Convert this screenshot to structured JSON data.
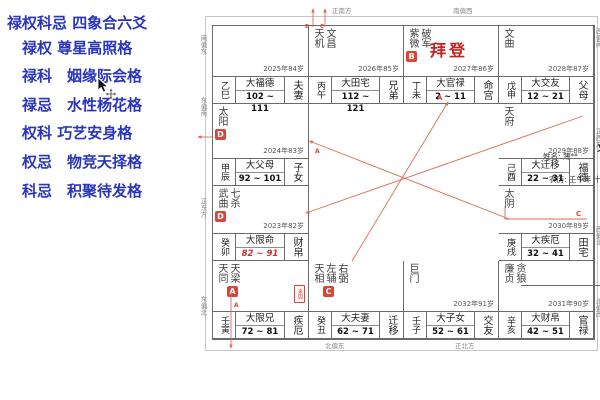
{
  "sidebar": {
    "color": "#2936bb",
    "title": "禄权科忌 四象合六爻",
    "items": [
      "禄权 尊星高照格",
      "禄科　姻缘际会格",
      "禄忌　水性杨花格",
      "权科 巧艺安身格",
      "权忌　物竞天择格",
      "科忌　积聚待发格"
    ]
  },
  "center": {
    "brand": "文墨天机",
    "version": "pro 2.0.3",
    "code": "9EJrQ",
    "name": "姓名: 薄**",
    "gender_bureau": "阳男 水二局",
    "lunar_birth": "农历: 壬午年 十月十三日辰时"
  },
  "highlight_name": "拜登",
  "compass": {
    "top": [
      "正南方",
      "南偏西"
    ],
    "bottom": [
      "北偏东",
      "正北方"
    ],
    "left": [
      "南偏东",
      "东偏南",
      "正东方",
      "东偏北"
    ],
    "right": [
      "西偏南",
      "正西方",
      "西偏北",
      "北偏西"
    ]
  },
  "palaces": [
    {
      "pos": [
        0,
        0
      ],
      "gz": "乙巳",
      "stars": [],
      "badges": [],
      "year": "2025年84岁",
      "decade": "大福德",
      "range": "102 ~ 111",
      "label": "夫妻"
    },
    {
      "pos": [
        1,
        0
      ],
      "gz": "丙午",
      "stars": [
        "天机",
        "文昌"
      ],
      "badges": [],
      "year": "2026年85岁",
      "decade": "大田宅",
      "range": "112 ~ 121",
      "label": "兄弟"
    },
    {
      "pos": [
        2,
        0
      ],
      "gz": "丁未",
      "stars": [
        "紫微",
        "破军"
      ],
      "badges": [
        {
          "letter": "B",
          "star": 0
        }
      ],
      "year": "2027年86岁",
      "decade": "大官禄",
      "range": "2 ~ 11",
      "label": "命宫",
      "highlight": true
    },
    {
      "pos": [
        3,
        0
      ],
      "gz": "戊申",
      "stars": [
        "文曲"
      ],
      "badges": [],
      "year": "2028年87岁",
      "decade": "大交友",
      "range": "12 ~ 21",
      "label": "父母"
    },
    {
      "pos": [
        3,
        1
      ],
      "gz": "己酉",
      "stars": [
        "天府"
      ],
      "badges": [],
      "year": "2029年88岁",
      "decade": "大迁移",
      "range": "22 ~ 31",
      "label": "福德"
    },
    {
      "pos": [
        3,
        2
      ],
      "gz": "庚戌",
      "stars": [
        "太阴"
      ],
      "badges": [],
      "year": "2030年89岁",
      "decade": "大疾厄",
      "range": "32 ~ 41",
      "label": "田宅"
    },
    {
      "pos": [
        3,
        3
      ],
      "gz": "辛亥",
      "stars": [
        "廉贞",
        "贪狼"
      ],
      "badges": [],
      "year": "2031年90岁",
      "decade": "大财帛",
      "range": "42 ~ 51",
      "label": "官禄"
    },
    {
      "pos": [
        2,
        3
      ],
      "gz": "壬子",
      "stars": [
        "巨门"
      ],
      "badges": [],
      "year": "2032年91岁",
      "decade": "大子女",
      "range": "52 ~ 61",
      "label": "交友"
    },
    {
      "pos": [
        1,
        3
      ],
      "gz": "癸丑",
      "stars": [
        "天相",
        "左辅",
        "右弼"
      ],
      "badges": [
        {
          "letter": "C",
          "star": 1
        }
      ],
      "year": "",
      "decade": "大夫妻",
      "range": "62 ~ 71",
      "label": "迁移"
    },
    {
      "pos": [
        0,
        3
      ],
      "gz": "壬寅",
      "stars": [
        "天同",
        "天梁"
      ],
      "badges": [
        {
          "letter": "A",
          "star": 1
        }
      ],
      "year": "",
      "decade": "大限兄",
      "range": "72 ~ 81",
      "label": "疾厄",
      "tag": "来因"
    },
    {
      "pos": [
        0,
        2
      ],
      "gz": "癸卯",
      "stars": [
        "武曲",
        "七杀"
      ],
      "badges": [
        {
          "letter": "D",
          "star": 0
        }
      ],
      "year": "2023年82岁",
      "decade": "大限命",
      "range": "82 ~ 91",
      "range_red": true,
      "label": "财帛"
    },
    {
      "pos": [
        0,
        1
      ],
      "gz": "甲辰",
      "stars": [
        "太阳"
      ],
      "badges": [
        {
          "letter": "D",
          "star": 0
        }
      ],
      "year": "2024年83岁",
      "decade": "大父母",
      "range": "92 ~ 101",
      "label": "子女"
    }
  ],
  "overlay_letters": [
    {
      "t": "B",
      "x": 305,
      "y": 28,
      "s": 5.5
    },
    {
      "t": "C",
      "x": 320,
      "y": 28,
      "s": 5.5
    },
    {
      "t": "A",
      "x": 437,
      "y": 100,
      "s": 7
    },
    {
      "t": "A",
      "x": 315,
      "y": 153,
      "s": 6
    },
    {
      "t": "C",
      "x": 576,
      "y": 216,
      "s": 7
    },
    {
      "t": "A",
      "x": 234,
      "y": 307,
      "s": 6
    }
  ],
  "colors": {
    "accent_red": "#d8463b",
    "line_red": "#de6b56",
    "name_red": "#c92020",
    "purple": "#7a2fc0",
    "sidebar_blue": "#2936bb"
  }
}
